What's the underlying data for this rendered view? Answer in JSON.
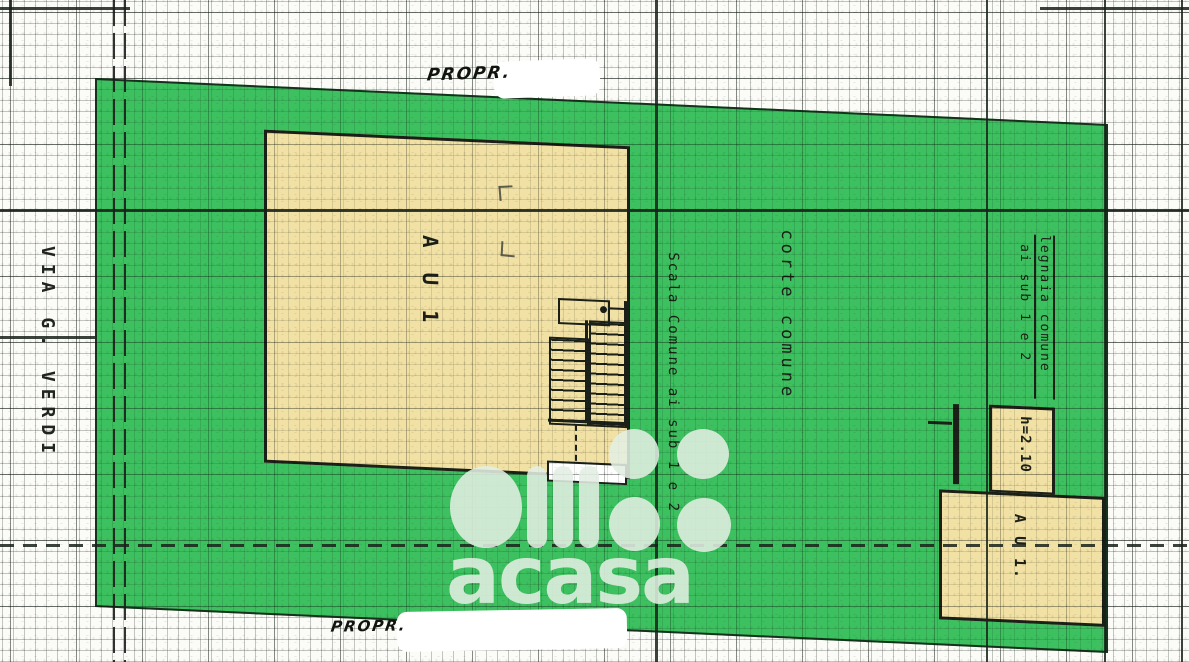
{
  "labels": {
    "street": "VIA G. VERDI",
    "owner_top": "PROPR.",
    "owner_bottom": "PROPR.",
    "unit_main": "A U 1",
    "unit_secondary": "A U 1.",
    "stairs": "Scala Comune ai sub 1 e 2",
    "courtyard": "corte comune",
    "woodshed_line1": "legnaia comune",
    "woodshed_line2": "ai sub 1 e 2",
    "height": "h=2.10"
  },
  "watermark": {
    "brand": "acasa",
    "logo_icon": "acasa-circle-bars-logo",
    "dots_icon": "acasa-four-dots-logo"
  },
  "colors": {
    "parcel_green": "#3dc05f",
    "building_yellow": "#f2e1a4",
    "ink": "#1b2018",
    "paper": "#fbfbf7",
    "watermark": "rgba(226,238,227,0.88)"
  }
}
